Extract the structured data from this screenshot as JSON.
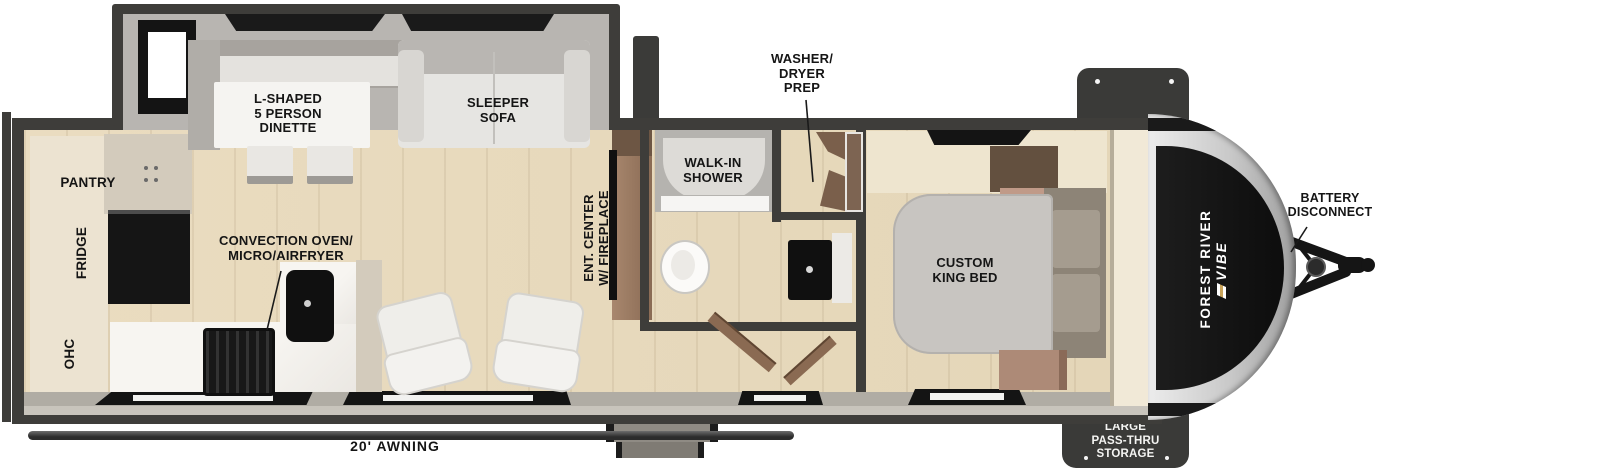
{
  "brand": {
    "manufacturer": "FOREST RIVER",
    "model": "VIBE"
  },
  "rooms": {
    "dinette": "L-SHAPED\n5 PERSON\nDINETTE",
    "sleeper_sofa": "SLEEPER\nSOFA",
    "washer_dryer_prep": "WASHER/\nDRYER\nPREP",
    "walk_in_shower": "WALK-IN\nSHOWER",
    "pantry": "PANTRY",
    "fridge": "FRIDGE",
    "ohc": "OHC",
    "convection": "CONVECTION OVEN/\nMICRO/AIRFRYER",
    "ent_center": "ENT. CENTER\nW/ FIREPLACE",
    "king_bed": "CUSTOM\nKING BED",
    "battery_disconnect": "BATTERY\nDISCONNECT",
    "pass_thru_storage": "LARGE\nPASS-THRU\nSTORAGE",
    "awning": "20' AWNING"
  },
  "colors": {
    "wall": "#3e3d3a",
    "floor_wood": "#e8dcc2",
    "slide_interior": "#b6b3ae",
    "counter_marble": "#f4f2ee",
    "appliance_black": "#161616",
    "cabinet_brown": "#7c6450",
    "bed_gray": "#c8c5c1",
    "cap_decal": "#121212",
    "storage_box": "#3a3a38",
    "label_text": "#151515"
  }
}
